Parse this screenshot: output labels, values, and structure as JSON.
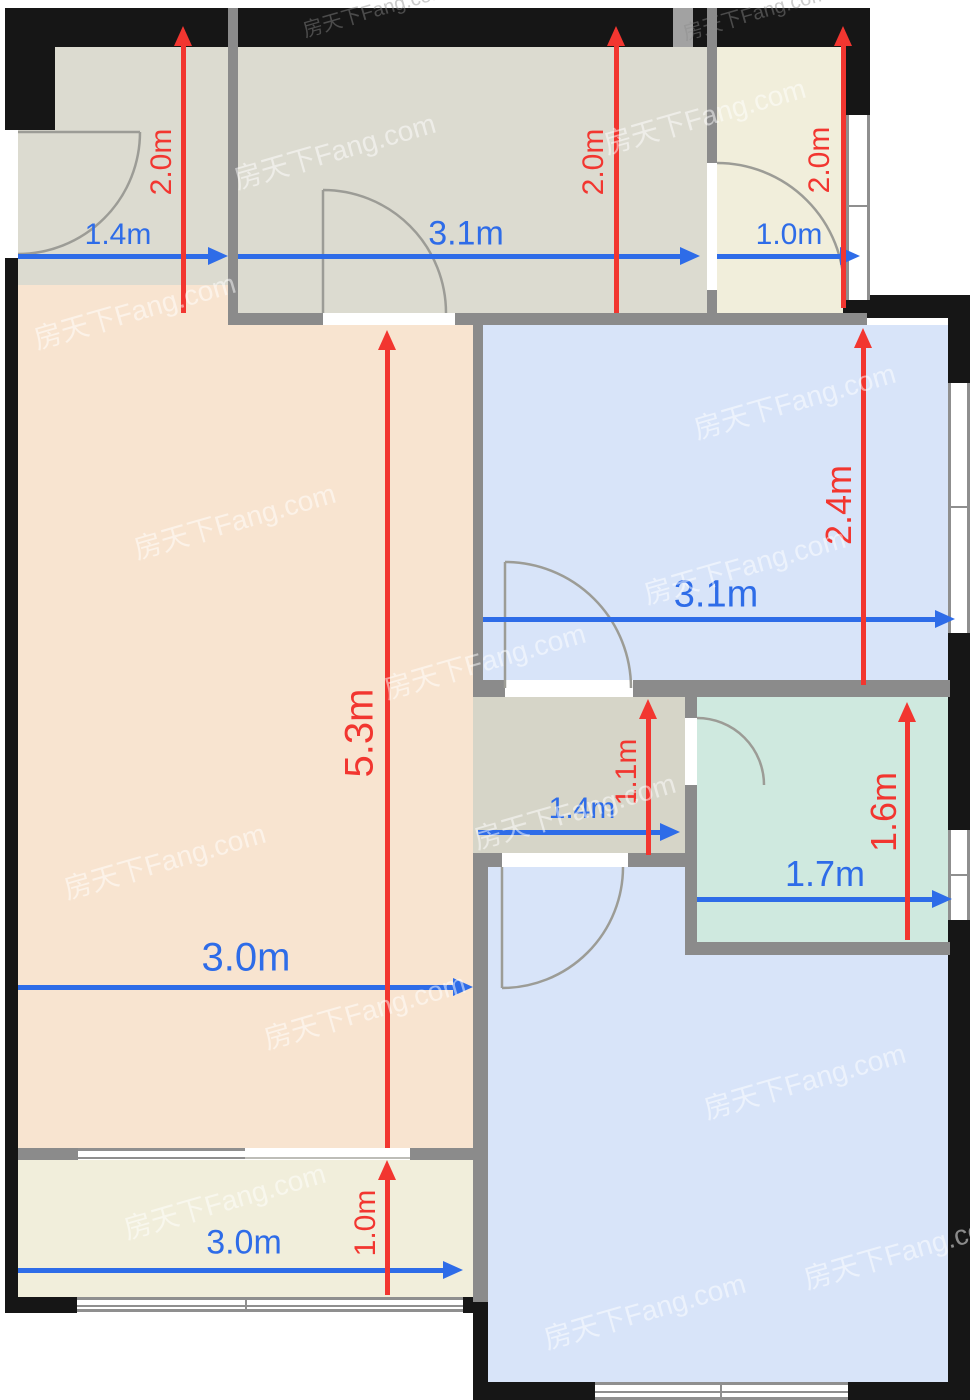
{
  "watermark": {
    "text": "房天下Fang.com"
  },
  "colors": {
    "dimension_horizontal_arrow": "#2e6ce8",
    "dimension_vertical_arrow": "#f23630",
    "wall_exterior": "#161616",
    "wall_interior": "#8b8b8b",
    "room_gray_green": "#dcdbd0",
    "room_yellow": "#f1eedb",
    "room_salmon": "#f8e4d0",
    "room_blue": "#d8e4f9",
    "room_teal": "#cfe9df"
  },
  "rooms": {
    "top_left_room": {
      "width": "1.4m",
      "height": "2.0m"
    },
    "top_middle_room": {
      "width": "3.1m",
      "height": "2.0m"
    },
    "top_right_room": {
      "width": "1.0m",
      "height": "2.0m"
    },
    "living_area": {
      "width": "3.0m",
      "height": "5.3m"
    },
    "right_bedroom": {
      "width": "3.1m",
      "height": "2.4m"
    },
    "hallway": {
      "width": "1.4m",
      "height": "1.1m"
    },
    "bathroom": {
      "width": "1.7m",
      "height": "1.6m"
    },
    "balcony": {
      "width": "3.0m",
      "height": "1.0m"
    }
  }
}
